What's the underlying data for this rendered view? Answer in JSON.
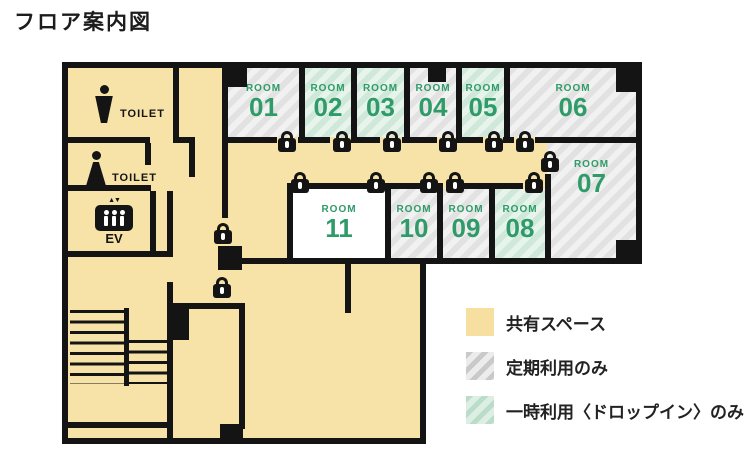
{
  "title": "フロア案内図",
  "colors": {
    "shared_yellow": "#F7E3A8",
    "accent_green": "#2E9B68",
    "wall_black": "#141414"
  },
  "legend": {
    "items": [
      {
        "label": "共有スペース",
        "type": "shared"
      },
      {
        "label": "定期利用のみ",
        "type": "regular"
      },
      {
        "label": "一時利用〈ドロップイン〉のみ",
        "type": "dropin"
      }
    ]
  },
  "rooms": [
    {
      "label": "ROOM",
      "number": "01",
      "type": "regular"
    },
    {
      "label": "ROOM",
      "number": "02",
      "type": "dropin"
    },
    {
      "label": "ROOM",
      "number": "03",
      "type": "dropin"
    },
    {
      "label": "ROOM",
      "number": "04",
      "type": "regular"
    },
    {
      "label": "ROOM",
      "number": "05",
      "type": "dropin"
    },
    {
      "label": "ROOM",
      "number": "06",
      "type": "regular"
    },
    {
      "label": "ROOM",
      "number": "07",
      "type": "regular"
    },
    {
      "label": "ROOM",
      "number": "08",
      "type": "dropin"
    },
    {
      "label": "ROOM",
      "number": "09",
      "type": "regular"
    },
    {
      "label": "ROOM",
      "number": "10",
      "type": "regular"
    },
    {
      "label": "ROOM",
      "number": "11",
      "type": "open"
    }
  ],
  "facilities": {
    "toilet_male": "TOILET",
    "toilet_female": "TOILET",
    "elevator": "EV",
    "elevator_arrows": "▲▼"
  }
}
